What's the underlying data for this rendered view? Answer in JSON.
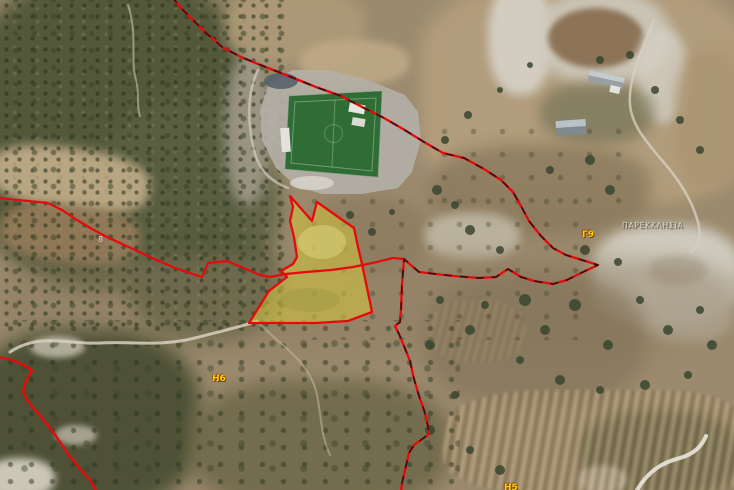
{
  "map": {
    "description": "satellite cadastral map with parcel boundaries",
    "labels": {
      "village": "ΠΑΡΕΚΚΛΗΣΙΑ",
      "block_g9": "Γ9",
      "block_h6": "Η6",
      "block_h5": "Η5",
      "parcel_8": "8"
    },
    "colors": {
      "boundary_red": "#e8090b",
      "boundary_dash": "#141414",
      "parcel_fill": "#d8cc3c",
      "pitch_green": "#2f6d35",
      "label_yellow": "#ffd400",
      "village_label": "#ddd5cb"
    },
    "features": {
      "stadium": "football-stadium",
      "parcel": "highlighted-parcel",
      "village_area": "chalk-quarry-terrain"
    }
  }
}
